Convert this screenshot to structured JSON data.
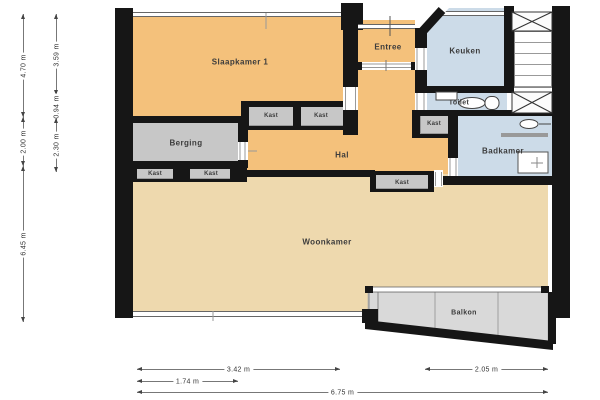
{
  "rooms": {
    "slaapkamer1": "Slaapkamer 1",
    "entree": "Entree",
    "keuken": "Keuken",
    "toilet": "Toilet",
    "badkamer": "Badkamer",
    "berging": "Berging",
    "hal": "Hal",
    "woonkamer": "Woonkamer",
    "balkon": "Balkon"
  },
  "kast_labels": [
    "Kast",
    "Kast",
    "Kast",
    "Kast",
    "Kast",
    "Kast"
  ],
  "dimensions": {
    "left_outer": [
      "4.70 m",
      "2.00 m",
      "6.45 m"
    ],
    "left_inner": [
      "3.59 m",
      "0.94 m",
      "2.30 m"
    ],
    "bottom": [
      "3.42 m",
      "2.05 m",
      "1.74 m",
      "6.75 m"
    ]
  },
  "colors": {
    "room_orange": "#f4c17b",
    "room_tan": "#eed9ae",
    "room_blue": "#ccdbe8",
    "room_gray": "#c7c7c7",
    "balcony_gray": "#d9d9d9",
    "wall_black": "#161616"
  }
}
